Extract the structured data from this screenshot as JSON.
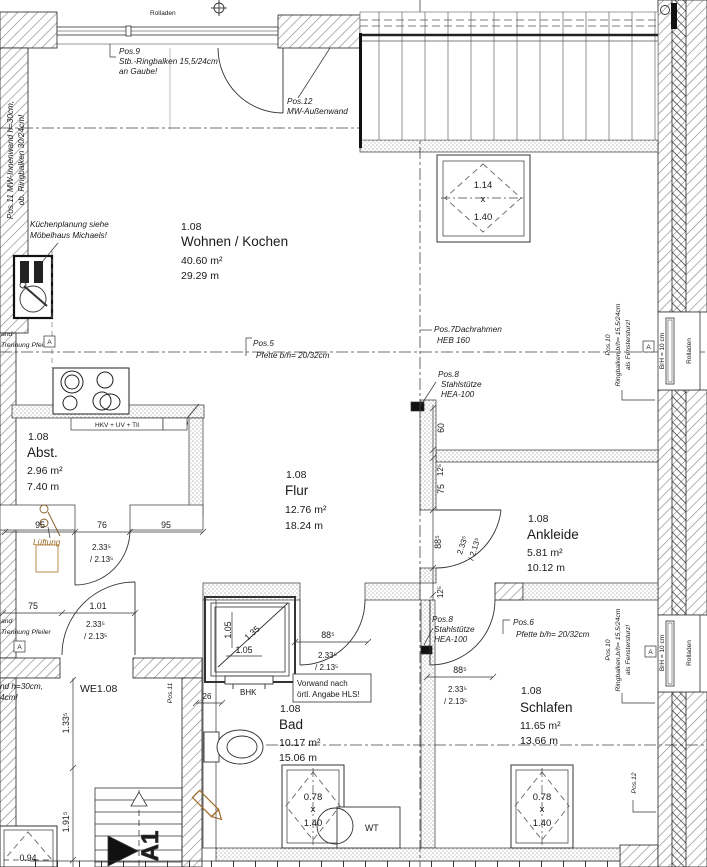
{
  "colors": {
    "ink": "#1a1a1a",
    "accent_orange": "#a06a28",
    "hatch_gray": "#8a8a8a"
  },
  "rooms": {
    "wohnen": {
      "nr": "1.08",
      "name": "Wohnen / Kochen",
      "area": "40.60 m²",
      "per": "29.29 m"
    },
    "abst": {
      "nr": "1.08",
      "name": "Abst.",
      "area": "2.96 m²",
      "per": "7.40 m"
    },
    "flur": {
      "nr": "1.08",
      "name": "Flur",
      "area": "12.76 m²",
      "per": "18.24 m"
    },
    "ankleide": {
      "nr": "1.08",
      "name": "Ankleide",
      "area": "5.81 m²",
      "per": "10.12 m"
    },
    "bad": {
      "nr": "1.08",
      "name": "Bad",
      "area": "10.17 m²",
      "per": "15.06 m"
    },
    "schlafen": {
      "nr": "1.08",
      "name": "Schlafen",
      "area": "11.65 m²",
      "per": "13.66 m"
    }
  },
  "pos": {
    "p5a": "Pos.5",
    "p5b": "Pfette b/h= 20/32cm",
    "p6a": "Pos.6",
    "p6b": "Pfette b/h= 20/32cm",
    "p7a": "Pos.7Dachrahmen",
    "p7b": "HEB 160",
    "p8a": "Pos.8",
    "p8b": "Stahlstütze",
    "p8c": "HEA-100",
    "p9a": "Pos.9",
    "p9b": "Stb.-Ringbalken 15,5/24cm",
    "p9c": "an Gaube!",
    "p10a": "Pos.10",
    "p10b": "Ringbalken,b/h= 15,5/24cm",
    "p10c": "als Fenstersturz!",
    "p11long1": "Pos.11 MW-Innenwand h=30cm,",
    "p11long2": "ob. Ringbalken 30/24cm!",
    "p11": "Pos.11",
    "p12a": "Pos.12",
    "p12b": "MW-Außenwand",
    "p12": "Pos.12"
  },
  "labels": {
    "rolladen": "Rolladen",
    "we": "WE1.08",
    "hkv": "HKV + UV + Tll",
    "bhk": "BHK",
    "wt": "WT",
    "stair": "A1",
    "marker": "A",
    "lueftung": "Lüftung",
    "vorwand1": "Vorwand nach",
    "vorwand2": "örtl. Angabe HLS!",
    "kueche1": "Küchenplanung siehe",
    "kueche2": "Möbelhaus Michaels!",
    "wand1": "and",
    "wand2": "Trennung Pfeiler",
    "wandcut1": "nd h=30cm,",
    "wandcut2": "4cm!",
    "brh": "BrH = 10 cm"
  },
  "dims": {
    "d95": "95",
    "d76": "76",
    "d75": "75",
    "d101": "1.01",
    "d60": "60",
    "d125": "12⁵",
    "d885": "88⁵",
    "doorA": "2.33⁵",
    "doorB": "/ 2.13⁵",
    "d26": "26",
    "d1335": "1.33⁵",
    "d1915": "1.91⁵",
    "d135": "1.35",
    "d105": "1.05",
    "d094": "0.94"
  },
  "windows": {
    "roof_large": {
      "w": "1.14",
      "sep": "x",
      "h": "1.40"
    },
    "roof_small": {
      "w": "0.78",
      "sep": "x",
      "h": "1.40"
    }
  }
}
